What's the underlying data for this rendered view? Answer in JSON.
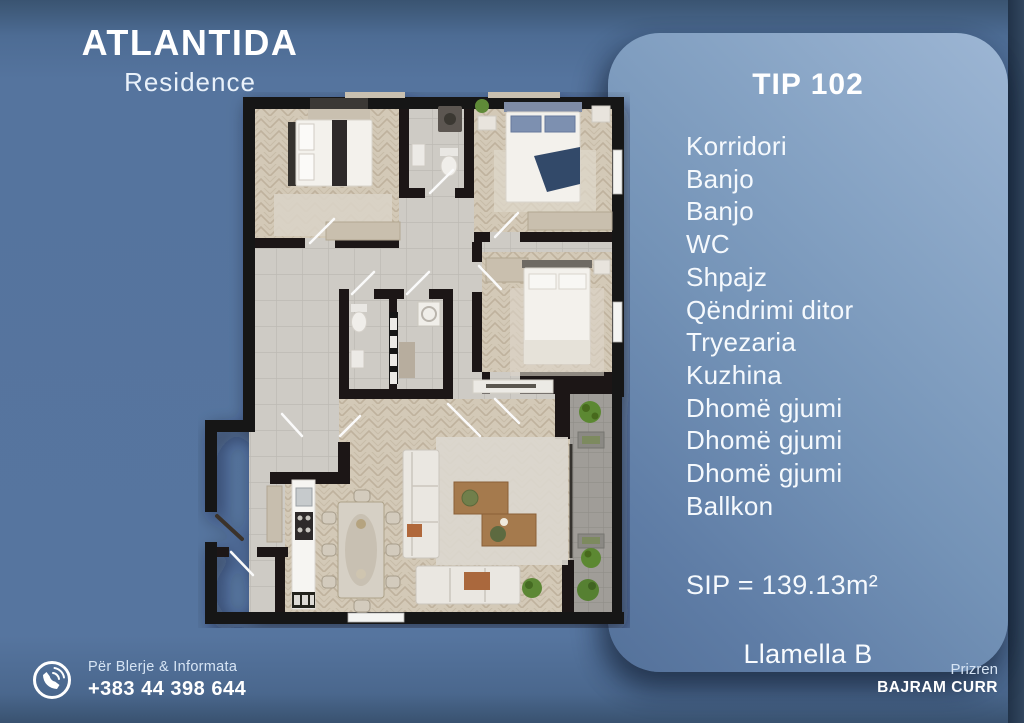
{
  "brand": {
    "name": "ATLANTIDA",
    "subtitle": "Residence"
  },
  "unit_panel": {
    "title": "TIP 102",
    "rooms": [
      "Korridori",
      "Banjo",
      "Banjo",
      "WC",
      "Shpajz",
      "Qëndrimi ditor",
      "Tryezaria",
      "Kuzhina",
      "Dhomë gjumi",
      "Dhomë gjumi",
      "Dhomë gjumi",
      "Ballkon"
    ],
    "area": "SIP = 139.13m²",
    "block": "Llamella B"
  },
  "contact": {
    "label": "Për Blerje & Informata",
    "phone": "+383 44 398 644",
    "icon": "phone-icon"
  },
  "location": {
    "city": "Prizren",
    "name": "BAJRAM CURR"
  },
  "floorplan": {
    "alt": "3D top view floor plan of apartment TIP 102 with three bedrooms, living-dining area, kitchen, two bathrooms, WC, storage and balcony"
  },
  "colors": {
    "background": "#55749e",
    "panel_light": "#9db6d4",
    "panel_dark": "#54719a",
    "edge_strip": "#2a3d53",
    "text": "#ffffff",
    "wall": "#171513",
    "wood_floor": "#d3c9b7",
    "tile_floor": "#cecbc5"
  }
}
